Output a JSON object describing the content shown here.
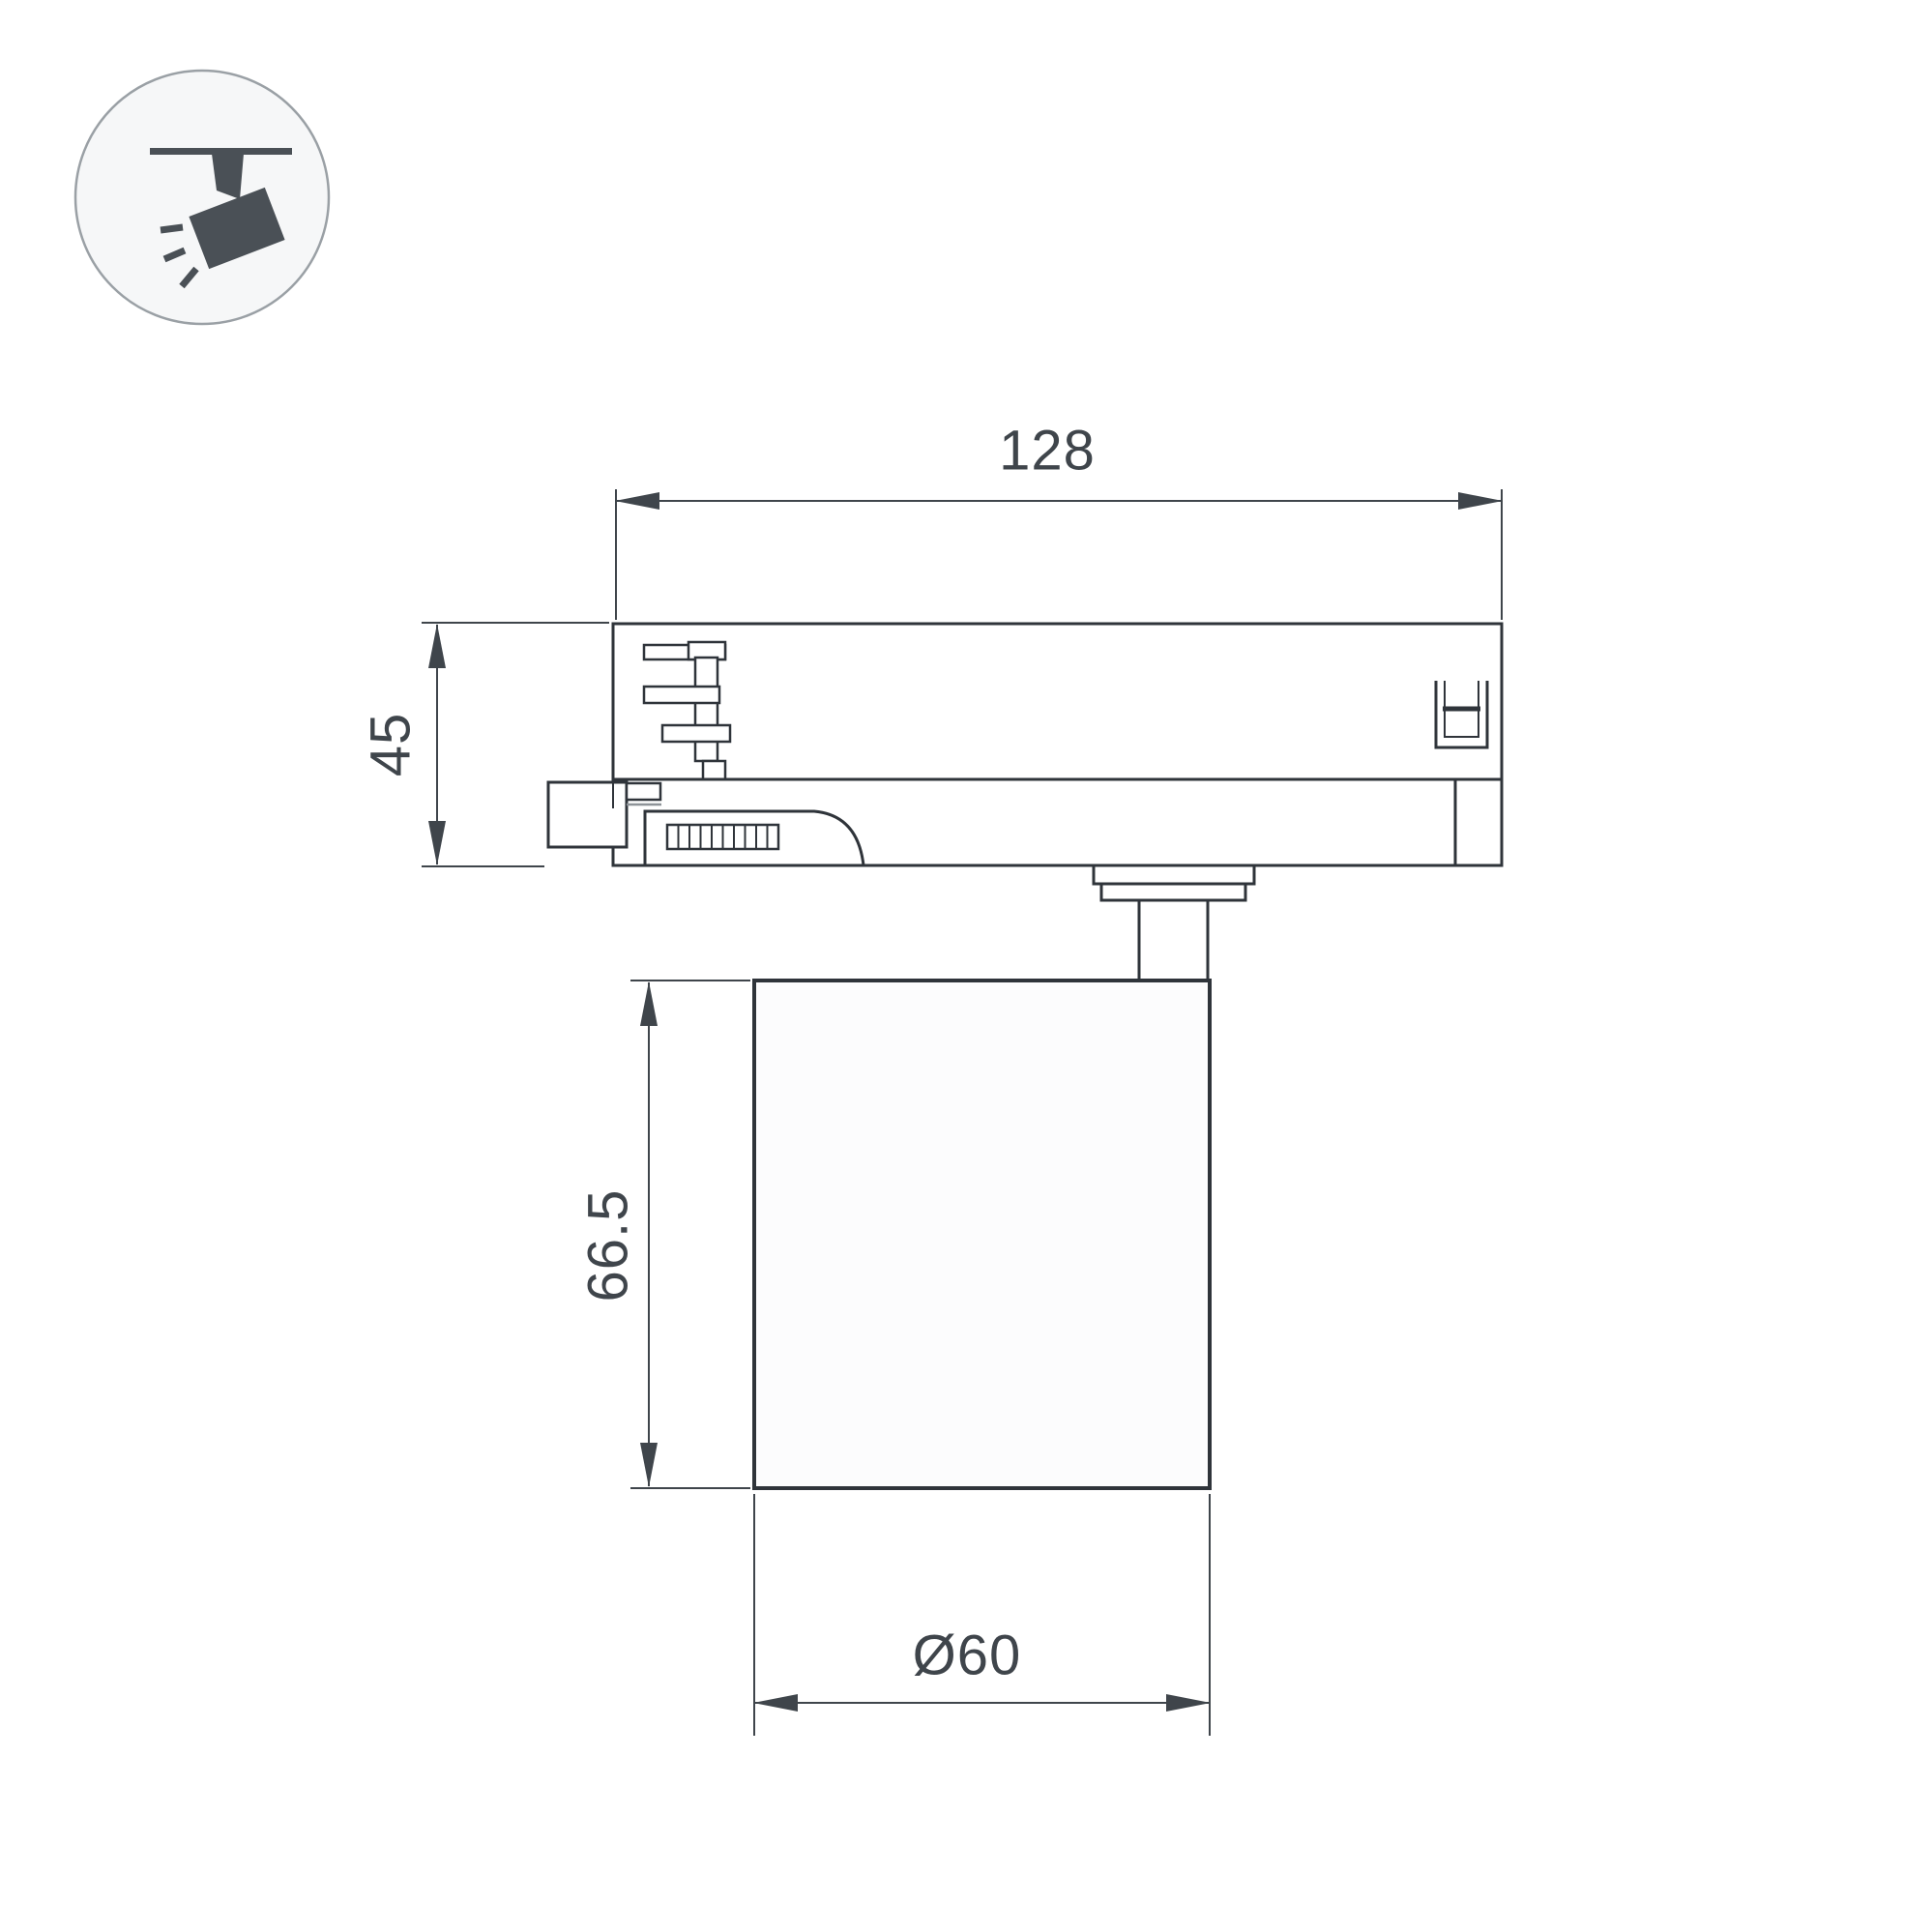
{
  "page": {
    "background_color": "#ffffff"
  },
  "icon": {
    "name": "track-spotlight-icon",
    "glyph_color": "#4a5056",
    "circle_fill": "#f6f7f8",
    "circle_stroke": "#9aa0a5"
  },
  "drawing": {
    "outline_color": "#2f343a",
    "dimension_color": "#3f454b",
    "labels": {
      "adapter_width": "128",
      "adapter_height": "45",
      "lamp_height": "66.5",
      "lamp_diameter": "Ø60"
    }
  }
}
